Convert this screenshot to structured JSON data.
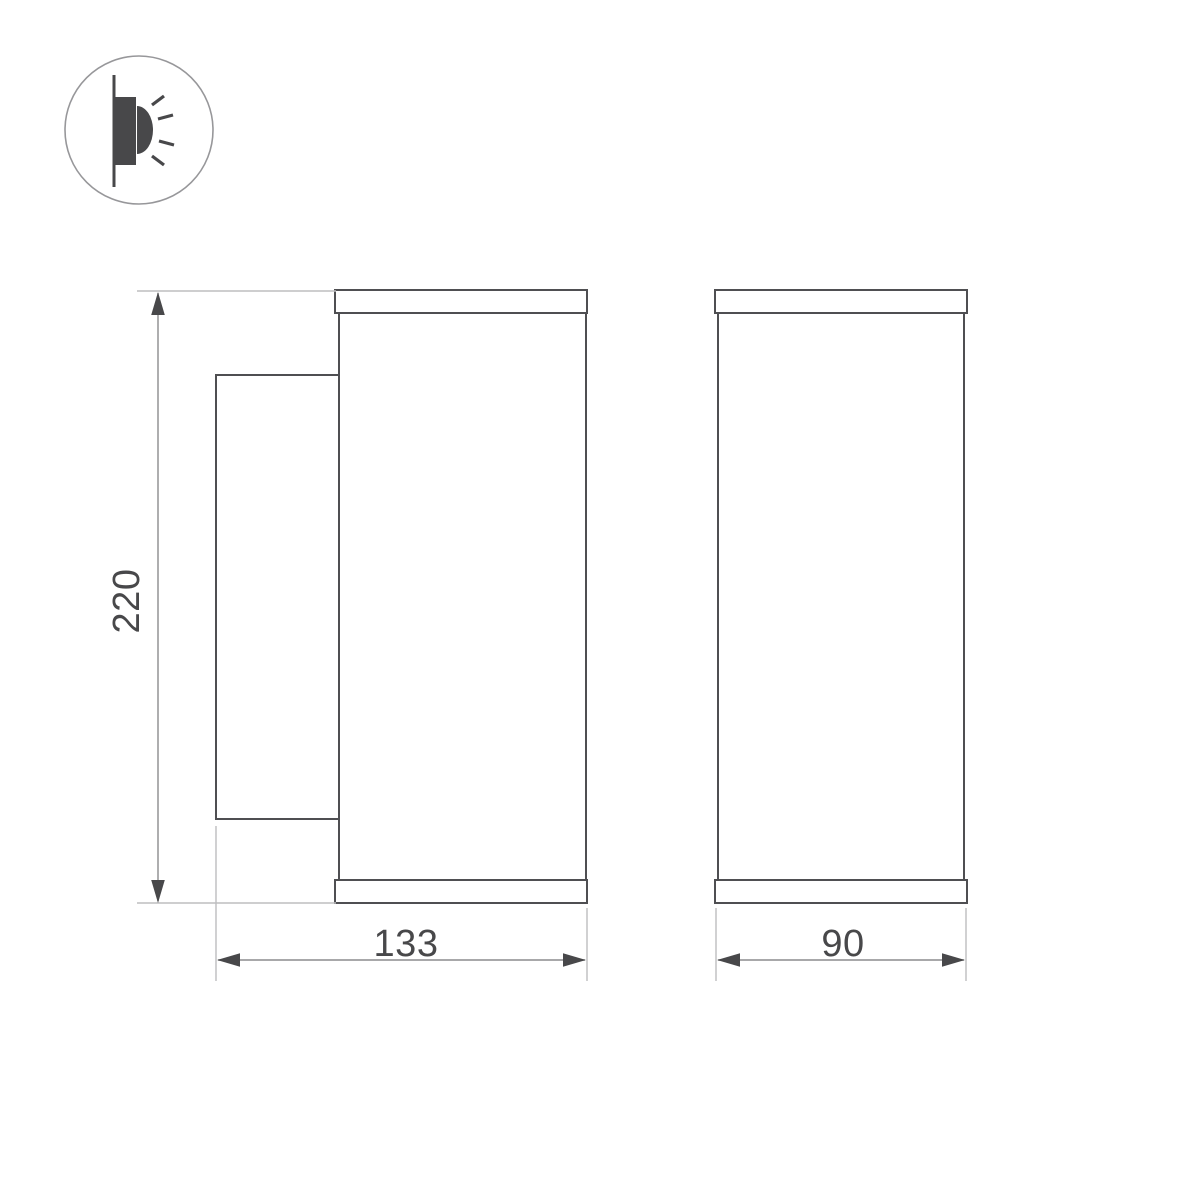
{
  "icon": {
    "name": "wall-mount-light-emitting-icon"
  },
  "views": {
    "side_view": {
      "name": "side-view"
    },
    "front_view": {
      "name": "front-view"
    }
  },
  "dimensions": {
    "height_label": "220",
    "depth_label": "133",
    "width_label": "90"
  },
  "colors": {
    "background": "#ffffff",
    "outline": "#4f4f52",
    "dimension_line": "#8b8b8d",
    "extension_line": "#bdbdbf",
    "arrows_and_text": "#48484a",
    "icon_circle_stroke": "#97979a"
  }
}
